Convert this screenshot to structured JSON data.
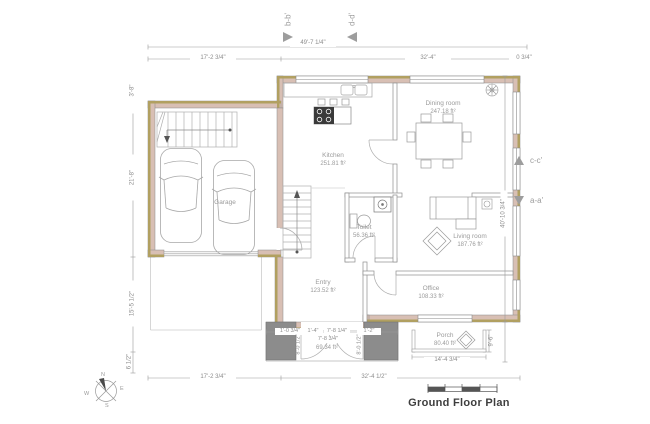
{
  "title": "Ground Floor Plan",
  "markers": {
    "b": "b-b'",
    "d": "d-d'",
    "c": "c-c'",
    "a": "a-a'"
  },
  "compass": {
    "n": "N",
    "e": "E",
    "s": "S",
    "w": "W"
  },
  "rooms": {
    "kitchen": {
      "name": "Kitchen",
      "area": "251.81 ft²"
    },
    "dining": {
      "name": "Dining room",
      "area": "247.18 ft²"
    },
    "living": {
      "name": "Living room",
      "area": "187.76 ft²"
    },
    "office": {
      "name": "Office",
      "area": "108.33 ft²"
    },
    "toilet": {
      "name": "Toilet",
      "area": "56.36 ft²"
    },
    "entry": {
      "name": "Entry",
      "area": "123.52 ft²"
    },
    "porch": {
      "name": "Porch",
      "area": "80.40 ft²"
    },
    "garage": {
      "name": "Garage"
    },
    "stoop_area": "69.34 ft²"
  },
  "dims": {
    "top_total": "49'-7 1/4\"",
    "top_left": "17'-2 3/4\"",
    "top_mid": "32'-4\"",
    "top_right": "0 3/4\"",
    "left_top": "3'-8\"",
    "left_mid": "21'-8\"",
    "left_low": "15'-5 1/2\"",
    "left_bottom": "6 1/2\"",
    "right_total": "40'-10 3/4\"",
    "porch_height": "9'-6\"",
    "bottom_left": "17'-2 3/4\"",
    "bottom_mid": "32'-4 1/2\"",
    "porch_width": "14'-4 3/4\"",
    "entry_a": "1'-0 3/4\"",
    "entry_b": "1'-4\"",
    "entry_c": "7'-8 1/4\"",
    "entry_d": "1'-2\"",
    "entry_e": "7'-8 3/4\"",
    "door_left": "8'-0 1/2\"",
    "door_right": "8'-0 1/2\""
  },
  "colors": {
    "wall_fill": "#d8bfb4",
    "wall_edge": "#b1a061",
    "pier": "#8c8c8c",
    "line": "#9a9a9a",
    "text": "#9b9b9b"
  }
}
